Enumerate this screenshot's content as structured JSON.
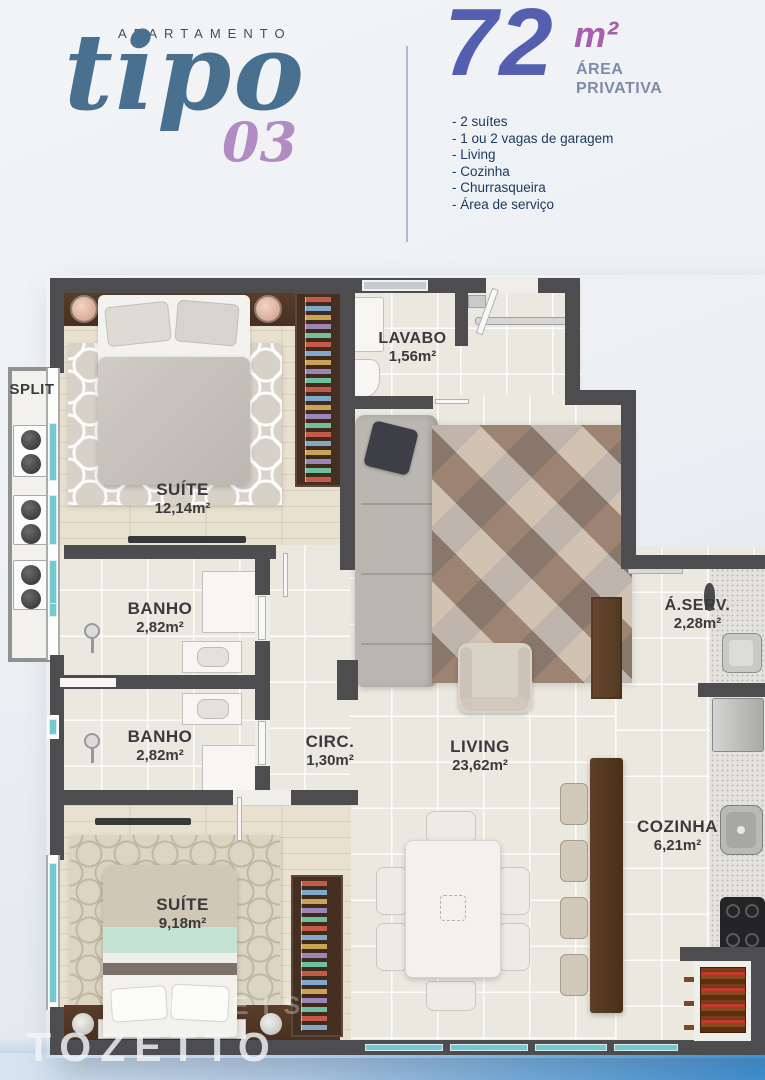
{
  "header": {
    "kicker": "APARTAMENTO",
    "brand": "tipo",
    "brand_number": "03",
    "area": {
      "value": "72",
      "unit": "m²",
      "label_line1": "ÁREA",
      "label_line2": "PRIVATIVA"
    },
    "features": [
      "- 2 suítes",
      "- 1 ou 2 vagas de garagem",
      "- Living",
      "- Cozinha",
      "- Churrasqueira",
      "- Área de serviço"
    ]
  },
  "floorplan": {
    "split_label": "SPLIT",
    "rooms": {
      "suite1": {
        "name": "SUÍTE",
        "area": "12,14m²"
      },
      "lavabo": {
        "name": "LAVABO",
        "area": "1,56m²"
      },
      "banho1": {
        "name": "BANHO",
        "area": "2,82m²"
      },
      "banho2": {
        "name": "BANHO",
        "area": "2,82m²"
      },
      "circ": {
        "name": "CIRC.",
        "area": "1,30m²"
      },
      "living": {
        "name": "LIVING",
        "area": "23,62m²"
      },
      "aserv": {
        "name": "Á.SERV.",
        "area": "2,28m²"
      },
      "cozinha": {
        "name": "COZINHA",
        "area": "6,21m²"
      },
      "suite2": {
        "name": "SUÍTE",
        "area": "9,18m²"
      }
    }
  },
  "watermark": {
    "primary": "TOZETTO",
    "secondary": "IMÓVEIS"
  },
  "colors": {
    "brand_blue": "#49708f",
    "brand_purple": "#b08cc3",
    "number_indigo": "#555fb0",
    "unit_purple": "#a55fae",
    "caption_gray": "#7e8cab",
    "feature_navy": "#1c3a60",
    "wall": "#4d4d4f",
    "window_teal": "#74c8cf",
    "wood_floor": "#e8e1d0",
    "tile_floor": "#ebe8e0",
    "wardrobe_brown": "#452f20",
    "band_blue": "#3e92d4"
  }
}
